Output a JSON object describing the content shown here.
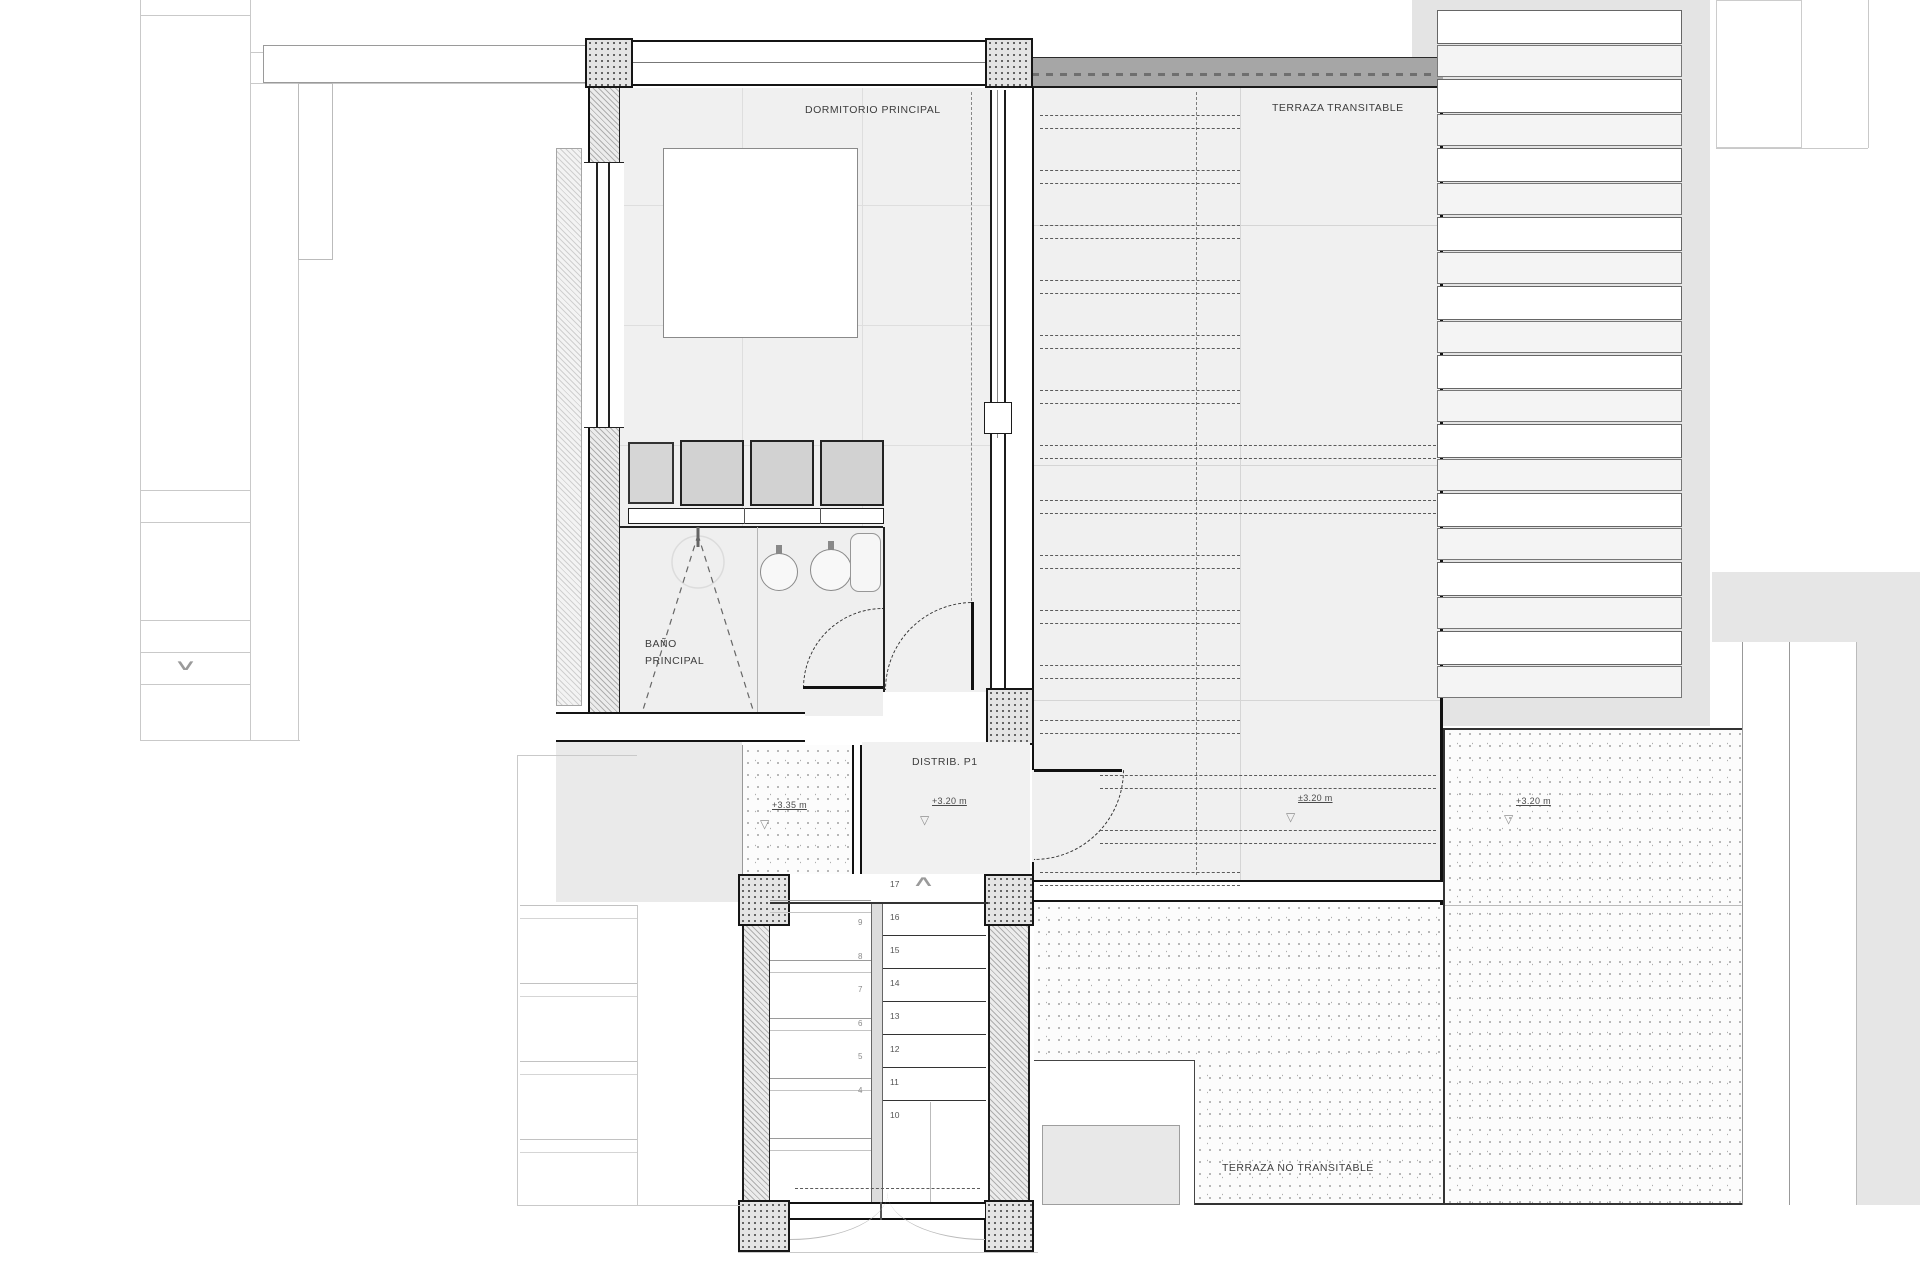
{
  "rooms": {
    "bedroom": "DORMITORIO PRINCIPAL",
    "terrace_walkable": "TERRAZA TRANSITABLE",
    "bathroom_line1": "BAÑO",
    "bathroom_line2": "PRINCIPAL",
    "distributor": "DISTRIB. P1",
    "terrace_non_walkable": "TERRAZA NO TRANSITABLE"
  },
  "elevation_markers": [
    {
      "location": "stair-landing",
      "text": "+3.35 m"
    },
    {
      "location": "distributor",
      "text": "+3.20 m"
    },
    {
      "location": "terrace-walkable",
      "text": "±3.20 m"
    },
    {
      "location": "terrace-non-walkable",
      "text": "+3.20 m"
    }
  ],
  "stairs": {
    "upper_flight_numbers": [
      "17",
      "16",
      "15",
      "14",
      "13",
      "12",
      "11",
      "10"
    ],
    "lower_flight_numbers": [
      "9",
      "8",
      "7",
      "6",
      "5",
      "4"
    ],
    "up_direction_symbol": "∧",
    "down_direction_symbol": "∨"
  },
  "symbols": {
    "elevation_triangle": "▽"
  },
  "colors": {
    "wall_dark": "#161616",
    "room_fill": "#f0f0f0",
    "hatch_line": "#aeaeae",
    "faint_line": "#c9c9c9",
    "label_text": "#3d3d3d"
  }
}
